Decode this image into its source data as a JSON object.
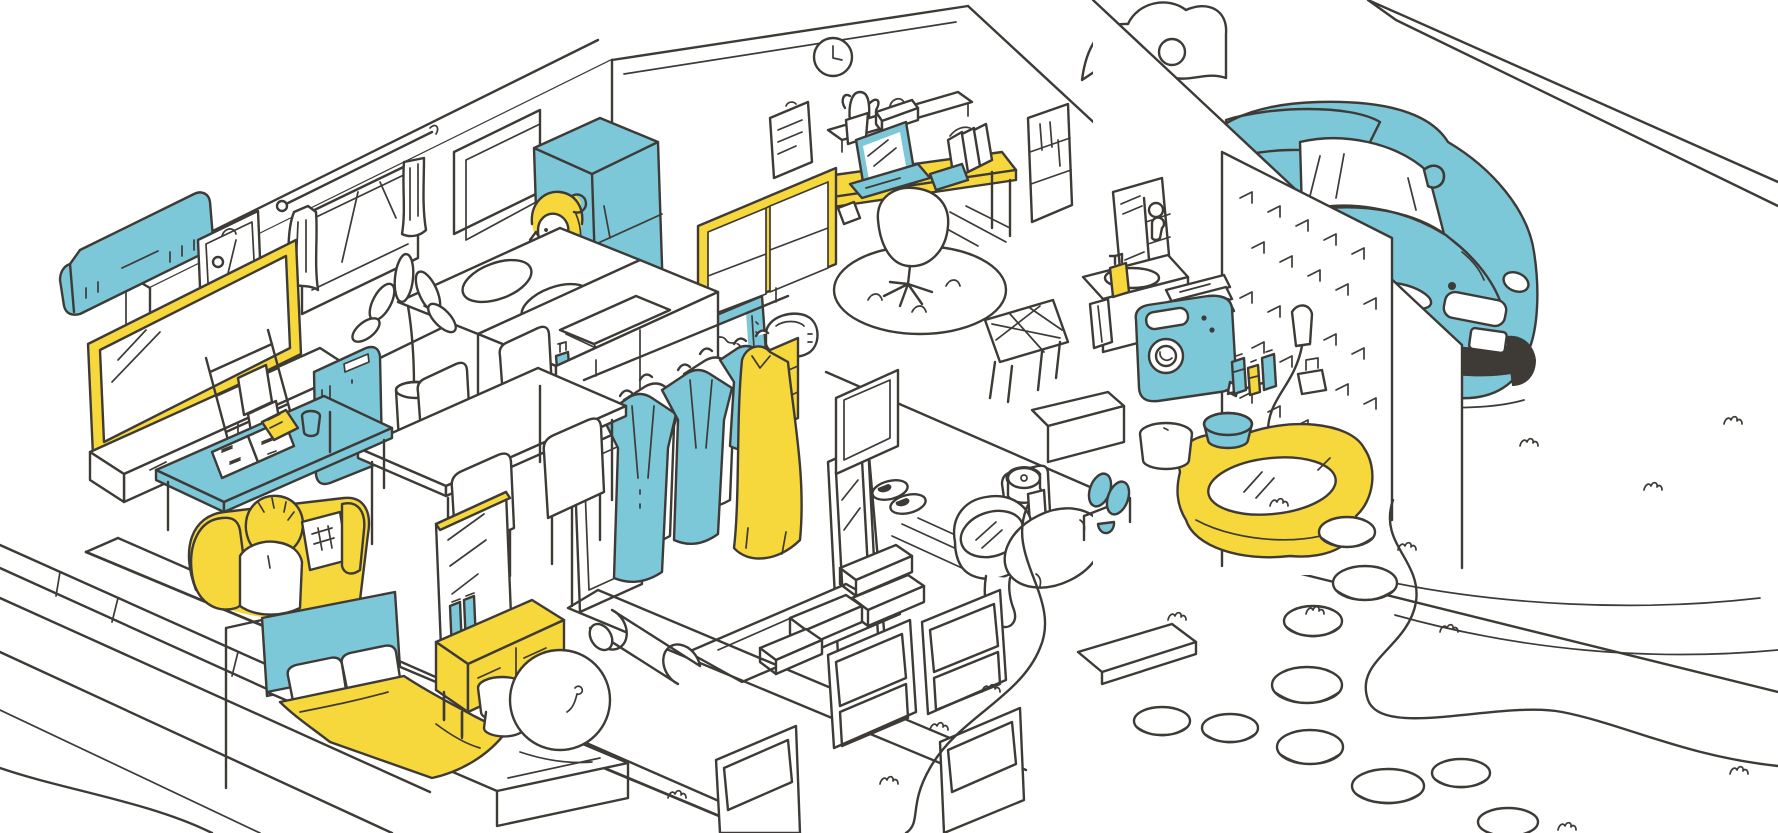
{
  "meta": {
    "title": "Isometric cutaway illustration of a one-story home with garage and garden",
    "style": "hand-drawn line art with blue and yellow accent colors on white"
  },
  "palette": {
    "ink": "#3e3a36",
    "blue": "#7cc7d8",
    "yellow": "#f6d73c",
    "dark": "#35302c",
    "paper": "#ffffff"
  },
  "rooms": {
    "living_room": {
      "label": "living room",
      "objects": [
        "air-conditioner",
        "wall-mirror",
        "curtained-window",
        "television",
        "magazine-ladder-rack",
        "air-purifier",
        "potted-plant",
        "dining-table",
        "dining-chairs",
        "low-table",
        "open-magazines",
        "sofa",
        "person-sitting"
      ]
    },
    "bedroom": {
      "label": "bedroom",
      "objects": [
        "double-bed",
        "pillows",
        "yellow-blanket",
        "dresser-with-mirror",
        "cosmetics",
        "stool"
      ]
    },
    "kitchen": {
      "label": "kitchen",
      "objects": [
        "two-burner-stove",
        "sink",
        "dish-soap",
        "refrigerator",
        "kitchen-hutch",
        "microwave",
        "rice-cooker",
        "person-on-phone",
        "wall-niche"
      ]
    },
    "study": {
      "label": "study",
      "objects": [
        "wall-clock",
        "wall-shelf",
        "cactus",
        "tissue-box",
        "clipboard",
        "desk",
        "laptop",
        "smartphone",
        "books",
        "notebook",
        "office-chair",
        "rug",
        "bookshelf"
      ]
    },
    "closet": {
      "label": "walk-in closet",
      "objects": [
        "hanging-rod",
        "jackets",
        "shirts",
        "blouse",
        "dress",
        "standing-mirror",
        "shoe-boxes",
        "storage-bins",
        "yoga-mat",
        "exercise-ball",
        "rug"
      ]
    },
    "toilet_room": {
      "label": "toilet room",
      "objects": [
        "toilet-open-lid",
        "toilet-paper",
        "slippers",
        "small-window",
        "floor-mat"
      ]
    },
    "washroom": {
      "label": "washroom / laundry",
      "objects": [
        "vanity-sink",
        "mirror-cabinet",
        "soap-dispenser",
        "hand-towel",
        "folded-towels",
        "washing-machine",
        "laundry-basket",
        "bottle-shelf",
        "entry-step"
      ]
    },
    "bathroom": {
      "label": "bathroom",
      "objects": [
        "bathtub",
        "hand-shower",
        "faucet",
        "tiled-wall",
        "wash-basin",
        "bath-stool",
        "bath-slippers"
      ]
    },
    "garage": {
      "label": "garage",
      "objects": [
        "car"
      ]
    },
    "exterior": {
      "label": "garden / exterior",
      "objects": [
        "wood-deck",
        "stepping-stones",
        "garden-path",
        "grass-tufts",
        "tree-foliage",
        "entrance-stone"
      ]
    }
  }
}
